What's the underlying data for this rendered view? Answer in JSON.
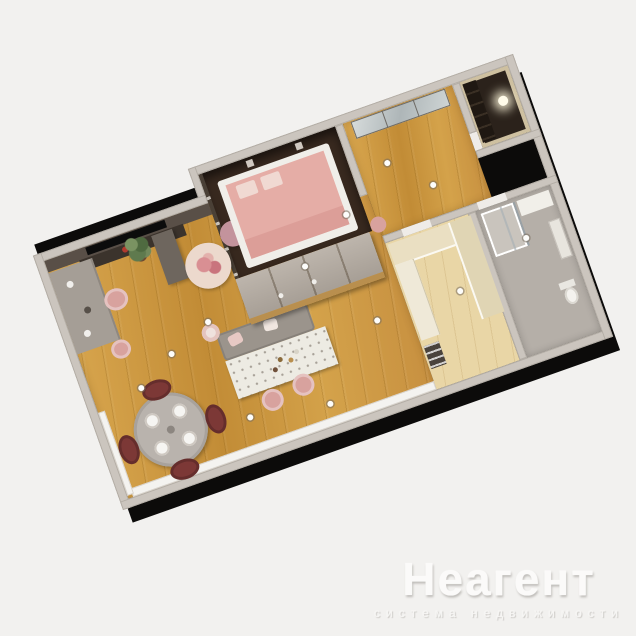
{
  "watermark": {
    "title": "Неагент",
    "subtitle": "система недвижимости"
  },
  "scene": {
    "type": "3d-floorplan-render",
    "rotation_deg": -19.5,
    "rooms": [
      "living-dining-room",
      "bedroom",
      "entry-hallway",
      "storage-room",
      "bathroom",
      "kitchen-niche"
    ],
    "furniture": [
      "tv",
      "tv-console",
      "desk",
      "desk-chair",
      "pouf",
      "potted-plant",
      "coffee-table-large",
      "coffee-table-small",
      "kitchen-island-bench",
      "kitchen-island-counter",
      "bar-stools",
      "round-dining-table",
      "dining-chairs",
      "double-bed",
      "wardrobe",
      "mirror-closet",
      "shower",
      "toilet",
      "washbasin",
      "cabinets",
      "ceiling-lights"
    ]
  },
  "palette": {
    "background": "#f2f1ef",
    "exterior": "#0c0b0a",
    "wall": "#cbc5be",
    "wall_edge": "#b3ada5",
    "wall_dark": "#594f47",
    "column": "#6e665e",
    "bedroom_floor": "#38291f",
    "storage_floor": "#2b221b",
    "wood_light": "#d9a74f",
    "wood_dark": "#c28c36",
    "pale_wood": "#e9d6a6",
    "bath_floor": "#b5afa8",
    "cabinet": "#eadfc2",
    "island_top": "#edebe3",
    "bench": "#9b948c",
    "gray_table": "#b9b3ad",
    "pink": "#d8a29e",
    "pink_light": "#f0d9d2",
    "mattress": "#e5ada6",
    "burgundy": "#7c3836",
    "mirror_a": "#d7dcdc",
    "mirror_b": "#aeb6b8",
    "plant_green": "#5f7a4e",
    "flower_red": "#b23a2e",
    "watermark": "#fbfaf9"
  }
}
